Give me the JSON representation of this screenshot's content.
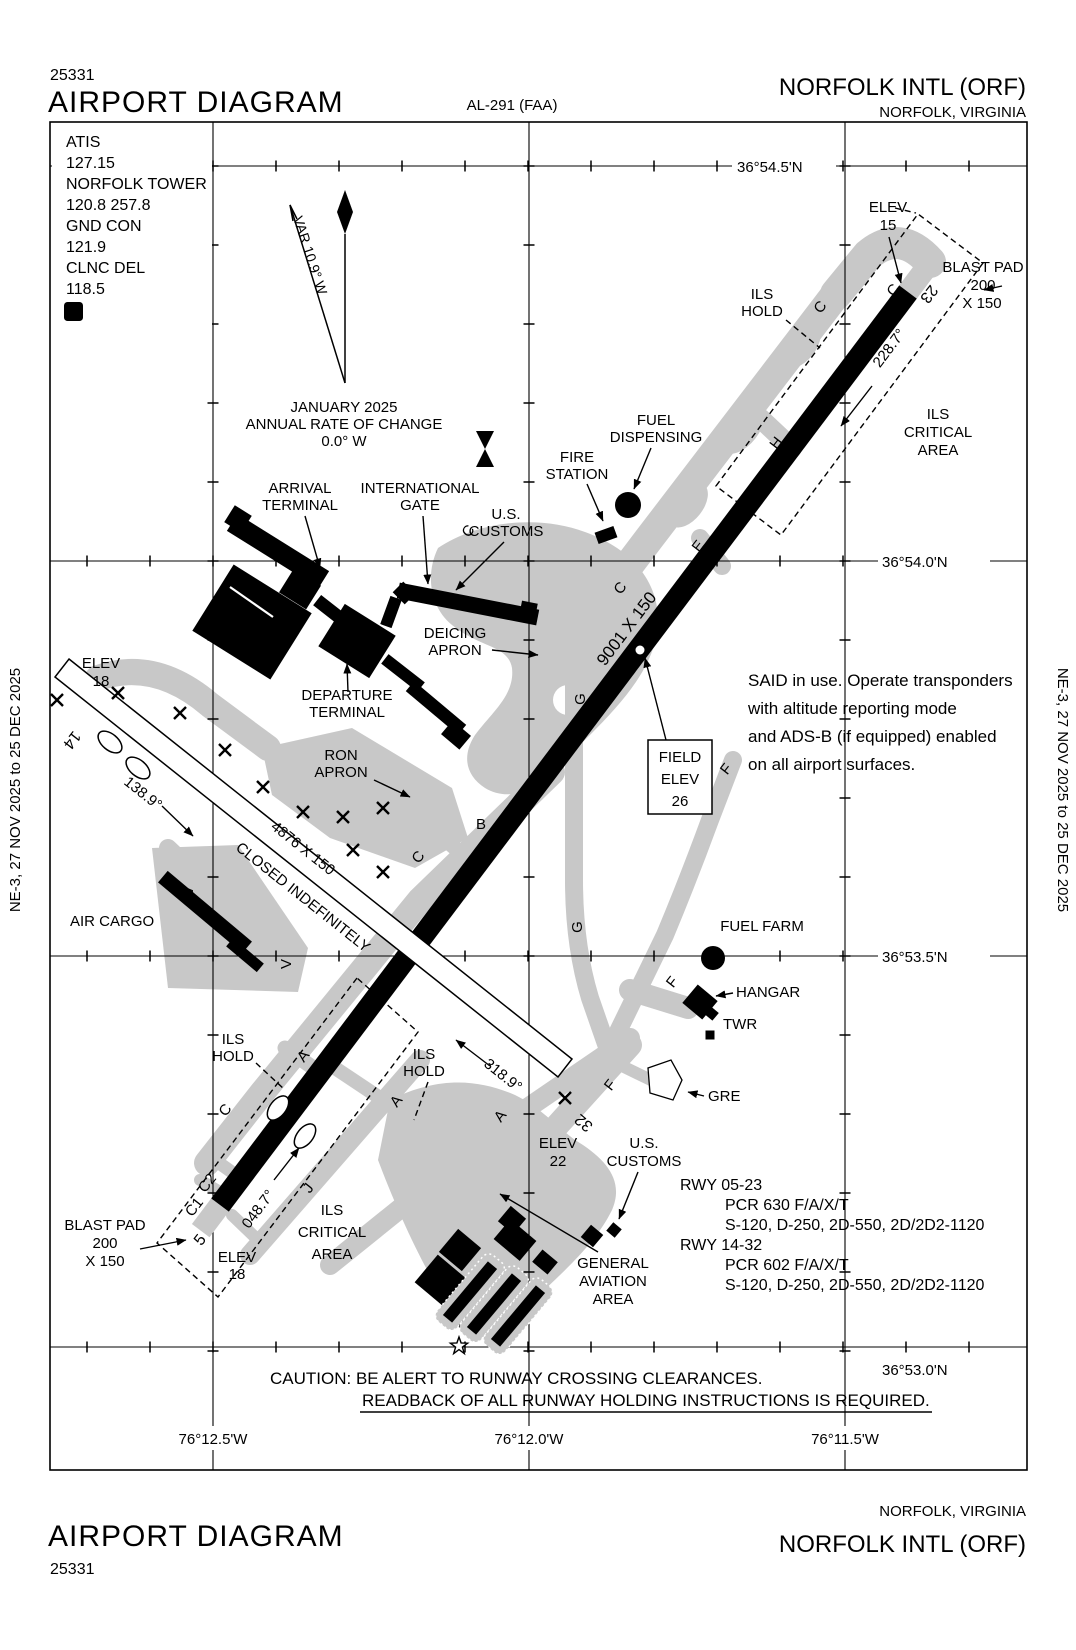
{
  "header": {
    "chart_number": "25331",
    "title": "AIRPORT DIAGRAM",
    "al_number": "AL-291 (FAA)",
    "airport": "NORFOLK INTL (ORF)",
    "city": "NORFOLK, VIRGINIA"
  },
  "footer": {
    "title": "AIRPORT DIAGRAM",
    "chart_number": "25331",
    "airport": "NORFOLK INTL (ORF)",
    "city": "NORFOLK, VIRGINIA"
  },
  "side_note": "NE-3,  27 NOV 2025  to  25 DEC 2025",
  "comm": {
    "atis_label": "ATIS",
    "atis": "127.15",
    "tower_label": "NORFOLK TOWER",
    "tower": "120.8  257.8",
    "gnd_label": "GND CON",
    "gnd": "121.9",
    "clnc_label": "CLNC DEL",
    "clnc": "118.5",
    "atis_d": "D"
  },
  "compass": {
    "var_label": "VAR 10.9° W",
    "date": "JANUARY 2025",
    "rate1": "ANNUAL RATE OF CHANGE",
    "rate2": "0.0° W"
  },
  "grid": {
    "lat": [
      "36°54.5'N",
      "36°54.0'N",
      "36°53.5'N",
      "36°53.0'N"
    ],
    "lon": [
      "76°12.5'W",
      "76°12.0'W",
      "76°11.5'W"
    ]
  },
  "runway0523": {
    "num_sw": "5",
    "num_ne": "23",
    "size": "9001 X 150",
    "brg_ne": "228.7°",
    "brg_sw": "048.7°"
  },
  "runway1432": {
    "num_nw": "14",
    "num_se": "32",
    "size": "4876 X 150",
    "closed": "CLOSED INDEFINITELY",
    "brg_nw": "138.9°",
    "brg_se": "318.9°"
  },
  "taxiways": {
    "a": "A",
    "b": "B",
    "c": "C",
    "c1": "C1",
    "c2": "C2",
    "e": "E",
    "f": "F",
    "g": "G",
    "h": "H",
    "j": "J",
    "v": "V"
  },
  "labels": {
    "elev15": [
      "ELEV",
      "15"
    ],
    "elev18": [
      "ELEV",
      "18"
    ],
    "elev22": [
      "ELEV",
      "22"
    ],
    "blast_pad": [
      "BLAST PAD",
      "200",
      "X 150"
    ],
    "ils_hold": [
      "ILS",
      "HOLD"
    ],
    "ils_critical": [
      "ILS",
      "CRITICAL",
      "AREA"
    ],
    "fuel_dispensing": [
      "FUEL",
      "DISPENSING"
    ],
    "fire_station": [
      "FIRE",
      "STATION"
    ],
    "us_customs": [
      "U.S.",
      "CUSTOMS"
    ],
    "arrival_terminal": [
      "ARRIVAL",
      "TERMINAL"
    ],
    "international_gate": [
      "INTERNATIONAL",
      "GATE"
    ],
    "deicing_apron": [
      "DEICING",
      "APRON"
    ],
    "departure_terminal": [
      "DEPARTURE",
      "TERMINAL"
    ],
    "ron_apron": [
      "RON",
      "APRON"
    ],
    "air_cargo": "AIR CARGO",
    "fuel_farm": "FUEL FARM",
    "hangar": "HANGAR",
    "twr": "TWR",
    "gre": "GRE",
    "general_aviation": [
      "GENERAL",
      "AVIATION",
      "AREA"
    ],
    "field_elev": [
      "FIELD",
      "ELEV",
      "26"
    ]
  },
  "notes": {
    "said": [
      "SAID in use. Operate transponders",
      "with altitude reporting mode",
      "and ADS-B (if equipped) enabled",
      "on all airport surfaces."
    ],
    "caution1": "CAUTION: BE ALERT TO RUNWAY CROSSING CLEARANCES.",
    "caution2": "READBACK OF ALL RUNWAY HOLDING INSTRUCTIONS IS REQUIRED."
  },
  "rwy_data": {
    "r1": "RWY 05-23",
    "r1_pcr": "PCR 630 F/A/X/T",
    "r1_codes": "S-120, D-250, 2D-550, 2D/2D2-1120",
    "r2": "RWY 14-32",
    "r2_pcr": "PCR 602 F/A/X/T",
    "r2_codes": "S-120, D-250, 2D-550, 2D/2D2-1120"
  },
  "colors": {
    "apron": "#c8c8c8",
    "ink": "#000000",
    "paper": "#ffffff"
  }
}
